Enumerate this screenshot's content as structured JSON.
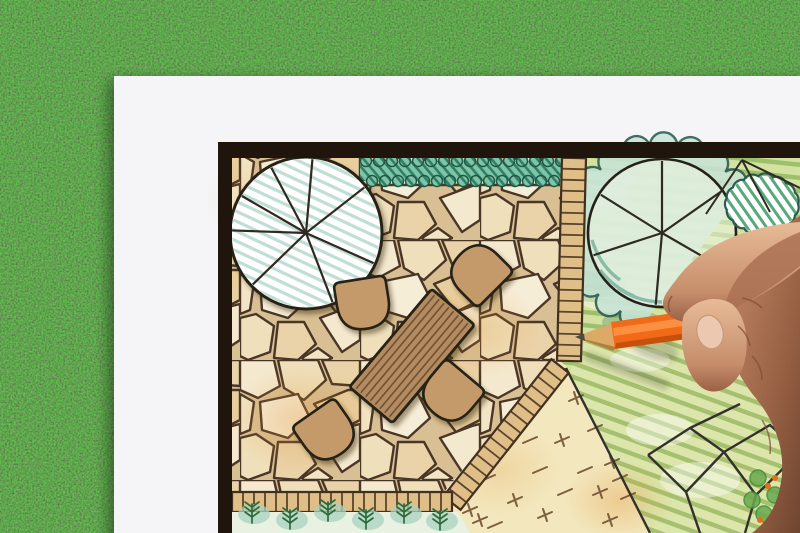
{
  "scene": {
    "description": "Photograph of a hand holding an orange colored pencil, drawing a garden landscape architecture plan on white paper lying on green grass. The plan shows a flagstone patio with a wooden table and four chairs, two large tree symbols, a teal hedge, brick edging paths, groundcover with cross marks, and green hatched lawn areas."
  },
  "colors": {
    "grass_base": "#3b6b35",
    "paper": "#f5f5f7",
    "frame": "#20150d",
    "stone_mortar": "#d8bf94",
    "stone_line": "#4a3626",
    "ink": "#262018",
    "table_fill": "#b48b60",
    "chair_fill": "#c59a6b",
    "hedge_fill": "#7ec4a8",
    "hedge_line": "#1f5644",
    "tree_hatch": "#9ccabc",
    "edging_fill": "#dfbe88",
    "edging_line": "#42301e",
    "garden_base": "#d3e2a0",
    "garden_stripe": "#8fb85f",
    "lawn_base": "#dce6ac",
    "lawn_stripe": "#97b75f",
    "cream": "#f3e7bd",
    "cream_mark": "#7d5f3f",
    "cream_orange": "#e6a65e",
    "shrub_line": "#2b5a50",
    "shrub_fill": "#c8e4d6",
    "pencil_orange": "#f06a17",
    "pencil_orange_light": "#ff9549",
    "pencil_orange_dark": "#c8500d",
    "pencil_wood": "#dcaa66",
    "pencil_tip": "#4d4a46",
    "skin_light": "#e8bb97",
    "skin_mid": "#c68e6b",
    "skin_dark": "#9a6245",
    "skin_deep": "#6f4530"
  },
  "plan": {
    "trees": [
      {
        "cx": 306,
        "cy": 233,
        "r": 76,
        "spokes": [
          -118,
          -85,
          -38,
          24,
          69,
          136,
          182,
          -150
        ],
        "hatch": true,
        "cloud": false
      },
      {
        "cx": 662,
        "cy": 233,
        "r": 74,
        "spokes": [
          -90,
          -148,
          162,
          95,
          30,
          -35
        ],
        "hatch": false,
        "cloud": true,
        "cloud_a0": 100,
        "cloud_a1": 350
      }
    ],
    "table": {
      "cx": 412,
      "cy": 356,
      "w": 56,
      "h": 128,
      "rot": 40,
      "planks": 8
    },
    "chairs": [
      {
        "cx": 363,
        "cy": 304,
        "rot": -9
      },
      {
        "cx": 478,
        "cy": 272,
        "rot": 135
      },
      {
        "cx": 450,
        "cy": 394,
        "rot": 40
      },
      {
        "cx": 327,
        "cy": 433,
        "rot": -35
      }
    ],
    "hedge": {
      "x1": 360,
      "x2": 562,
      "ytop": 161,
      "ybot": 181
    },
    "edging": [
      {
        "x1": 574,
        "y1": 158,
        "x2": 569,
        "y2": 361,
        "w": 24,
        "step": 11
      },
      {
        "x1": 560,
        "y1": 366,
        "x2": 452,
        "y2": 503,
        "w": 22,
        "step": 11
      },
      {
        "x1": 452,
        "y1": 502,
        "x2": 232,
        "y2": 502,
        "w": 20,
        "step": 11
      }
    ],
    "groundcover_marks": [
      [
        470,
        510
      ],
      [
        488,
        478
      ],
      [
        505,
        445
      ],
      [
        520,
        412
      ],
      [
        540,
        385
      ],
      [
        558,
        372
      ],
      [
        576,
        398
      ],
      [
        595,
        428
      ],
      [
        612,
        462
      ],
      [
        628,
        496
      ],
      [
        610,
        520
      ],
      [
        585,
        470
      ],
      [
        562,
        440
      ],
      [
        540,
        470
      ],
      [
        515,
        500
      ],
      [
        495,
        525
      ],
      [
        545,
        515
      ],
      [
        565,
        492
      ],
      [
        480,
        520
      ],
      [
        530,
        440
      ],
      [
        600,
        492
      ],
      [
        620,
        478
      ]
    ],
    "outline_paths": [
      [
        740,
        404,
        690,
        428
      ],
      [
        648,
        455,
        690,
        428,
        724,
        452,
        686,
        492,
        648,
        455
      ],
      [
        724,
        452,
        770,
        425,
        800,
        452,
        756,
        495,
        724,
        452
      ],
      [
        686,
        492,
        700,
        533
      ],
      [
        756,
        495,
        745,
        533
      ],
      [
        566,
        368,
        650,
        533
      ]
    ],
    "ferns": [
      [
        252,
        520
      ],
      [
        290,
        526
      ],
      [
        328,
        518
      ],
      [
        366,
        526
      ],
      [
        404,
        520
      ],
      [
        440,
        527
      ]
    ],
    "corner_plants": {
      "leaves": [
        [
          758,
          478
        ],
        [
          775,
          495
        ],
        [
          790,
          512
        ],
        [
          764,
          514
        ],
        [
          780,
          530
        ],
        [
          752,
          500
        ]
      ],
      "dots": [
        [
          768,
          486
        ],
        [
          784,
          506
        ],
        [
          760,
          520
        ],
        [
          775,
          478
        ],
        [
          792,
          496
        ]
      ]
    },
    "white_patches": [
      [
        600,
        200,
        30,
        14
      ],
      [
        620,
        300,
        40,
        12
      ],
      [
        660,
        430,
        34,
        16
      ],
      [
        700,
        480,
        40,
        18
      ],
      [
        590,
        250,
        24,
        10
      ],
      [
        640,
        360,
        30,
        12
      ],
      [
        610,
        180,
        26,
        10
      ]
    ]
  }
}
